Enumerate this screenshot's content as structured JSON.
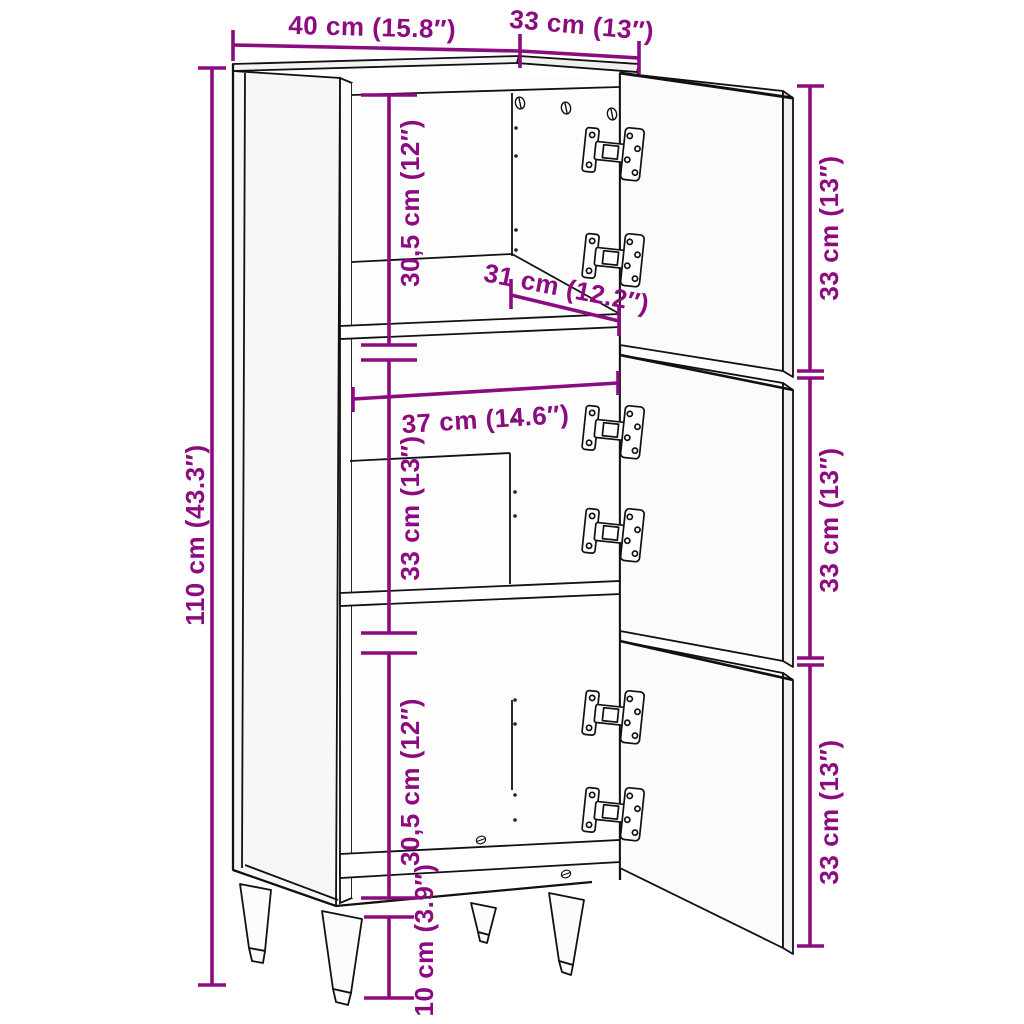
{
  "diagram": {
    "title": "Cabinet dimension diagram",
    "accent_color": "#8D0B80",
    "line_color": "#111111",
    "labels": {
      "top_width": "40 cm (15.8″)",
      "top_depth": "33 cm (13″)",
      "height": "110 cm (43.3″)",
      "compartment_top": "30,5 cm (12″)",
      "shelf_depth": "31 cm (12.2″)",
      "interior_width": "37 cm (14.6″)",
      "compartment_middle": "33 cm (13″)",
      "compartment_bottom": "30,5 cm (12″)",
      "door_top": "33 cm (13″)",
      "door_middle": "33 cm (13″)",
      "door_bottom": "33 cm (13″)",
      "leg_height": "10 cm (3.9″)"
    }
  }
}
